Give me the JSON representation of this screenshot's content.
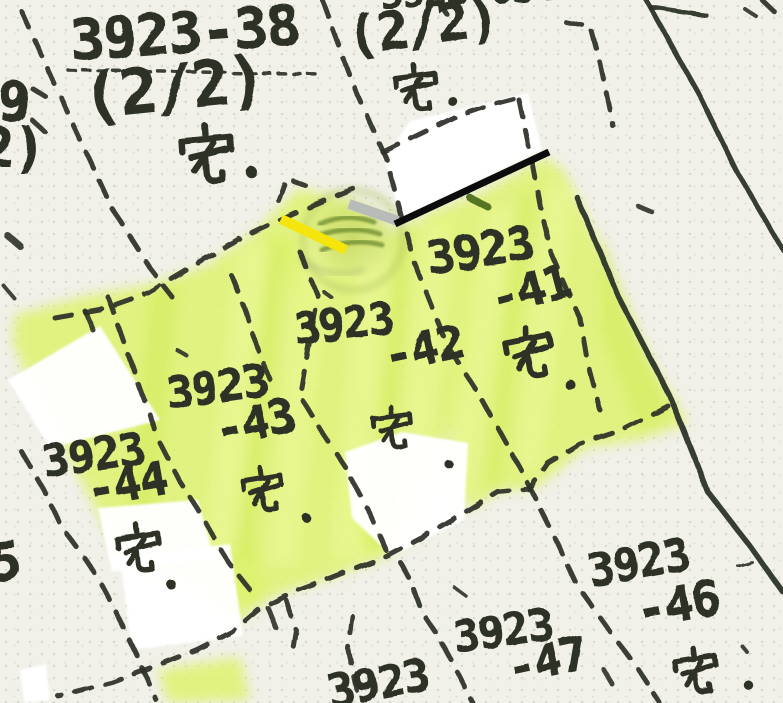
{
  "colors": {
    "paper": "#f1f0e9",
    "paper_dot": "#d7d7cf",
    "ink": "#2d3128",
    "highlight_green": "#def26e",
    "streak_light": "#f0fa9b",
    "streak_deep": "#cfe84f",
    "marker_yellow": "#f6e50a",
    "marker_silver": "#b7bcb8",
    "pen_black": "#0c0c0c",
    "whiteout": "#ffffff",
    "stamp_green": "#b9cf5e",
    "stamp_ink": "#55761c"
  },
  "labels": [
    {
      "text": "3923-38",
      "x": 72,
      "y": 18,
      "size": 56,
      "rot": -4
    },
    {
      "text": "(2/2)",
      "x": 86,
      "y": 72,
      "size": 62,
      "rot": -6
    },
    {
      "text": "宅·",
      "kind": "taku",
      "dot": true,
      "x": 176,
      "y": 124,
      "size": 64,
      "rot": -4
    },
    {
      "text": "3923-634",
      "x": 381,
      "y": -20,
      "size": 38,
      "rot": -3
    },
    {
      "text": "(2/2)",
      "x": 350,
      "y": 16,
      "size": 52,
      "rot": -8
    },
    {
      "text": "宅·",
      "kind": "taku",
      "dot": true,
      "x": 391,
      "y": 64,
      "size": 52,
      "rot": -6
    },
    {
      "text": "3923",
      "x": 430,
      "y": 240,
      "size": 46,
      "rot": -9
    },
    {
      "text": "-41",
      "x": 496,
      "y": 281,
      "size": 46,
      "rot": -15
    },
    {
      "text": "宅·",
      "kind": "taku",
      "dot": true,
      "x": 503,
      "y": 328,
      "size": 58,
      "rot": -10,
      "dot_dx": 64,
      "dot_dy": 44
    },
    {
      "text": "3923",
      "x": 296,
      "y": 312,
      "size": 43,
      "rot": -7
    },
    {
      "text": "-42",
      "x": 388,
      "y": 338,
      "size": 46,
      "rot": -12
    },
    {
      "text": "宅·",
      "kind": "taku",
      "dot": true,
      "x": 370,
      "y": 406,
      "size": 48,
      "rot": -6,
      "dot_dx": 76,
      "dot_dy": 46
    },
    {
      "text": "3923",
      "x": 169,
      "y": 376,
      "size": 44,
      "rot": -8
    },
    {
      "text": "-43",
      "x": 219,
      "y": 412,
      "size": 46,
      "rot": -12
    },
    {
      "text": "宅·",
      "kind": "taku",
      "dot": true,
      "x": 240,
      "y": 468,
      "size": 50,
      "rot": -8,
      "dot_dx": 64,
      "dot_dy": 38
    },
    {
      "text": "3923",
      "x": 45,
      "y": 444,
      "size": 44,
      "rot": -8
    },
    {
      "text": "-44",
      "x": 90,
      "y": 472,
      "size": 46,
      "rot": -10
    },
    {
      "text": "宅·",
      "kind": "taku",
      "dot": true,
      "x": 113,
      "y": 524,
      "size": 54,
      "rot": -6,
      "dot_dx": 56,
      "dot_dy": 44
    },
    {
      "text": "3923",
      "x": 591,
      "y": 553,
      "size": 44,
      "rot": -10
    },
    {
      "text": "-46",
      "x": 640,
      "y": 592,
      "size": 48,
      "rot": -10
    },
    {
      "text": "宅·",
      "kind": "taku",
      "dot": true,
      "x": 672,
      "y": 648,
      "size": 52,
      "rot": -8,
      "dot_dx": 76,
      "dot_dy": 26
    },
    {
      "text": "3923",
      "x": 456,
      "y": 620,
      "size": 43,
      "rot": -8
    },
    {
      "text": "-47",
      "x": 511,
      "y": 650,
      "size": 46,
      "rot": -12
    },
    {
      "text": "3923",
      "x": 331,
      "y": 674,
      "size": 44,
      "rot": -10
    },
    {
      "text": "9",
      "x": -2,
      "y": 80,
      "size": 54,
      "rot": 0
    },
    {
      "text": "2)",
      "x": -18,
      "y": 126,
      "size": 54,
      "rot": 0
    },
    {
      "text": "5",
      "x": -8,
      "y": 542,
      "size": 52,
      "rot": -6
    }
  ],
  "boundaries": {
    "dash_pattern": "17 14",
    "dashed": [
      {
        "points": [
          22,
          12,
          60,
          96,
          112,
          208,
          150,
          268,
          173,
          298
        ]
      },
      {
        "points": [
          68,
          70,
          322,
          74
        ],
        "w": 3.5,
        "dash": "7 8"
      },
      {
        "points": [
          322,
          0,
          352,
          82,
          386,
          158,
          414,
          262,
          447,
          345,
          480,
          396,
          520,
          468,
          550,
          528,
          577,
          585,
          612,
          634,
          640,
          672,
          660,
          703
        ]
      },
      {
        "points": [
          566,
          22,
          591,
          27,
          600,
          62,
          613,
          126
        ]
      },
      {
        "points": [
          383,
          152,
          420,
          134,
          455,
          117,
          490,
          105,
          517,
          98
        ]
      },
      {
        "points": [
          519,
          100,
          530,
          152,
          541,
          210,
          552,
          255,
          567,
          290,
          580,
          318,
          588,
          365,
          600,
          410
        ]
      },
      {
        "points": [
          55,
          318,
          100,
          310,
          148,
          293,
          200,
          262,
          242,
          238,
          292,
          214,
          333,
          197,
          360,
          186
        ]
      },
      {
        "points": [
          278,
          200,
          286,
          178,
          306,
          186
        ]
      },
      {
        "points": [
          300,
          252,
          318,
          296,
          308,
          350,
          300,
          396,
          322,
          432,
          346,
          468,
          370,
          514,
          386,
          550
        ]
      },
      {
        "points": [
          232,
          276,
          246,
          312,
          258,
          350,
          272,
          384
        ]
      },
      {
        "points": [
          108,
          297,
          120,
          330,
          140,
          388,
          160,
          443,
          180,
          482,
          202,
          516,
          228,
          562,
          258,
          600
        ]
      },
      {
        "points": [
          22,
          452,
          44,
          490,
          62,
          528,
          82,
          554,
          98,
          578,
          116,
          612,
          138,
          658,
          156,
          700
        ]
      },
      {
        "points": [
          668,
          406,
          622,
          430,
          580,
          444,
          548,
          463,
          530,
          489,
          498,
          492,
          462,
          514,
          420,
          538,
          386,
          556,
          330,
          578,
          292,
          592,
          258,
          610,
          232,
          632,
          196,
          650,
          158,
          665,
          112,
          682,
          58,
          696
        ]
      },
      {
        "points": [
          352,
          616,
          348,
          648,
          357,
          690
        ]
      },
      {
        "points": [
          286,
          600,
          296,
          630,
          292,
          654
        ]
      },
      {
        "points": [
          400,
          562,
          412,
          584,
          422,
          612,
          438,
          636,
          450,
          658,
          466,
          690,
          473,
          703
        ]
      },
      {
        "points": [
          762,
          0,
          783,
          20
        ]
      },
      {
        "points": [
          32,
          88,
          45,
          96
        ],
        "w": 5
      },
      {
        "points": [
          32,
          120,
          45,
          132
        ],
        "w": 5
      },
      {
        "points": [
          437,
          0,
          448,
          16
        ]
      }
    ],
    "solid": [
      {
        "points": [
          577,
          197,
          618,
          296,
          670,
          396,
          708,
          492,
          750,
          546,
          783,
          592
        ],
        "w": 5.5
      },
      {
        "points": [
          646,
          0,
          674,
          50,
          700,
          96,
          736,
          170,
          783,
          250
        ],
        "w": 5
      },
      {
        "points": [
          650,
          7,
          706,
          15
        ],
        "w": 4.5
      }
    ]
  },
  "marks": {
    "yellow_highlight_stroke": {
      "points": [
        281,
        219,
        346,
        250
      ],
      "w": 10
    },
    "silver_marker_stroke": {
      "points": [
        349,
        204,
        398,
        221
      ],
      "w": 10
    },
    "black_pen_line": {
      "points": [
        395,
        224,
        549,
        152
      ],
      "w": 7
    },
    "stamp_smudge": {
      "cx": 353,
      "cy": 236,
      "rx": 50,
      "ry": 44,
      "arcs": [
        "M320,224 Q346,212 374,222",
        "M314,237 Q349,224 380,234",
        "M322,250 Q353,237 382,245"
      ],
      "tail": "M302,260 Q330,280 362,270"
    }
  },
  "whiteout_patches": [
    [
      384,
      158,
      410,
      121,
      528,
      93,
      542,
      150,
      401,
      218
    ],
    [
      8,
      380,
      100,
      326,
      160,
      420,
      50,
      448
    ],
    [
      98,
      508,
      198,
      500,
      214,
      558,
      112,
      572
    ],
    [
      120,
      558,
      230,
      544,
      243,
      636,
      132,
      650
    ],
    [
      20,
      670,
      46,
      664,
      50,
      700,
      24,
      703
    ],
    [
      345,
      452,
      402,
      432,
      468,
      443,
      464,
      520,
      392,
      556,
      352,
      518
    ]
  ],
  "highlight_regions": [
    [
      15,
      315,
      90,
      295,
      150,
      285,
      205,
      266,
      255,
      232,
      300,
      240,
      318,
      300,
      308,
      380,
      330,
      460,
      362,
      520,
      387,
      556,
      330,
      578,
      290,
      590,
      252,
      606,
      225,
      590,
      185,
      585,
      145,
      568,
      112,
      540,
      88,
      494,
      55,
      430,
      28,
      380,
      12,
      340
    ],
    [
      255,
      232,
      298,
      188,
      350,
      200,
      394,
      232,
      440,
      212,
      470,
      242,
      472,
      340,
      452,
      420,
      432,
      480,
      402,
      545,
      387,
      556,
      356,
      540,
      330,
      470,
      306,
      400,
      300,
      310,
      280,
      250
    ],
    [
      394,
      232,
      430,
      212,
      478,
      194,
      545,
      157,
      565,
      172,
      580,
      202,
      614,
      282,
      652,
      362,
      688,
      424,
      640,
      440,
      585,
      448,
      536,
      488,
      500,
      491,
      468,
      510,
      446,
      470,
      456,
      380,
      470,
      300,
      456,
      240,
      420,
      214
    ],
    [
      215,
      552,
      256,
      542,
      266,
      600,
      236,
      624,
      206,
      600
    ],
    [
      158,
      670,
      240,
      657,
      250,
      700,
      168,
      703
    ]
  ],
  "highlight_streaks": {
    "light": [
      [
        238,
        250,
        268,
        244,
        232,
        560,
        204,
        556
      ],
      [
        300,
        238,
        330,
        232,
        296,
        566,
        268,
        562
      ],
      [
        362,
        228,
        392,
        224,
        360,
        560,
        332,
        556
      ],
      [
        424,
        222,
        454,
        218,
        420,
        540,
        394,
        540
      ],
      [
        486,
        210,
        514,
        205,
        470,
        500,
        444,
        498
      ],
      [
        548,
        180,
        574,
        190,
        540,
        470,
        516,
        468
      ]
    ],
    "deep": [
      [
        150,
        290,
        180,
        284,
        150,
        560,
        124,
        548
      ],
      [
        270,
        246,
        286,
        242,
        252,
        562,
        236,
        558
      ],
      [
        398,
        226,
        412,
        222,
        384,
        548,
        370,
        544
      ],
      [
        520,
        195,
        536,
        190,
        500,
        488,
        486,
        486
      ],
      [
        600,
        230,
        640,
        340,
        672,
        416,
        640,
        430,
        600,
        330
      ]
    ]
  },
  "ink_specks": [
    {
      "points": [
        8,
        236,
        20,
        246
      ],
      "w": 7
    },
    {
      "points": [
        4,
        286,
        14,
        298
      ],
      "w": 4
    },
    {
      "points": [
        85,
        311,
        93,
        330
      ],
      "w": 5
    },
    {
      "points": [
        268,
        608,
        276,
        628
      ],
      "w": 5
    },
    {
      "points": [
        638,
        206,
        652,
        212
      ],
      "w": 4.5
    },
    {
      "points": [
        744,
        8,
        756,
        16
      ],
      "w": 4
    },
    {
      "points": [
        455,
        588,
        466,
        596
      ],
      "w": 3.5
    },
    {
      "points": [
        604,
        670,
        613,
        685
      ],
      "w": 5
    },
    {
      "points": [
        177,
        350,
        187,
        356
      ],
      "w": 4
    },
    {
      "points": [
        738,
        566,
        752,
        562
      ],
      "w": 3
    },
    {
      "points": [
        324,
        292,
        332,
        298
      ],
      "w": 4
    },
    {
      "points": [
        742,
        646,
        747,
        652
      ],
      "w": 4
    },
    {
      "points": [
        470,
        198,
        488,
        207
      ],
      "w": 7,
      "color": "#47661a"
    }
  ]
}
